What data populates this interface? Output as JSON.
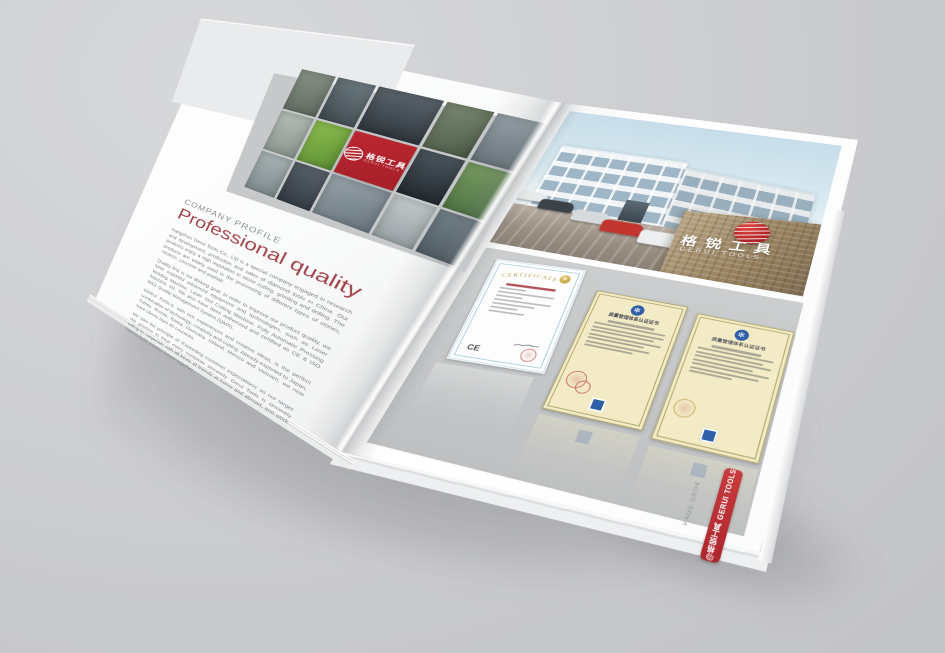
{
  "scene": {
    "background_color": "#cbcccf",
    "brand_red": "#b2252e",
    "ribbon_red": "#bf3138"
  },
  "left_page": {
    "logo_tile": {
      "cn": "格锐工具",
      "en": "GERUI TOOLS"
    },
    "eyebrow": "COMPANY PROFILE",
    "title": "Professional quality",
    "title_color": "#a4454c",
    "paragraphs": [
      "Hangzhou Gerui Tools Co., Ltd is a special company engaged in research and development, production and sales of diamond tools in China. Our products enjoy a high reputation in stone cutting, grinding and drilling. The products are widely used in the processing of different types of stones, ceramic, concrete and asphalt.",
      "Quality first is our lifelong goal. In order to improve our product quality, we have imported advanced equipment and technologies, such as Laser Welding Machine, Laser Slot Cutting Machine, Fully Automatic Pressing Machine, etc. We also have been authorized and certified as CE & ISO 9001 Quality Management System (QMS).",
      "GERUI TOOLS, with rich experiences and creative ideas, is the perfect combination of technology, creativity and cutting. Already exported to Japan, Turkey, Russia, Korea, Germany, Ireland, Mexico and Vietnam, we now have clients from 40 countries.",
      "We take the principle of 'Exceeding customer expectations' as our target. We promise to treat every customer sincerely. Gerui Tools is sincerely willing to cooperate with all kinds of friends at home and abroad, and work hard to build a better future together."
    ]
  },
  "right_page": {
    "wall": {
      "cn": "格锐工具",
      "en": "GERUI TOOLS"
    },
    "certificates": {
      "ce": {
        "arc_title": "CERTIFICATE",
        "mark": "CE"
      },
      "quality_cert_title": "质量管理体系认证证书"
    },
    "ribbon_label": "@格锐工具 GERUI TOOLS",
    "page_label": "PAGE 03/04"
  }
}
